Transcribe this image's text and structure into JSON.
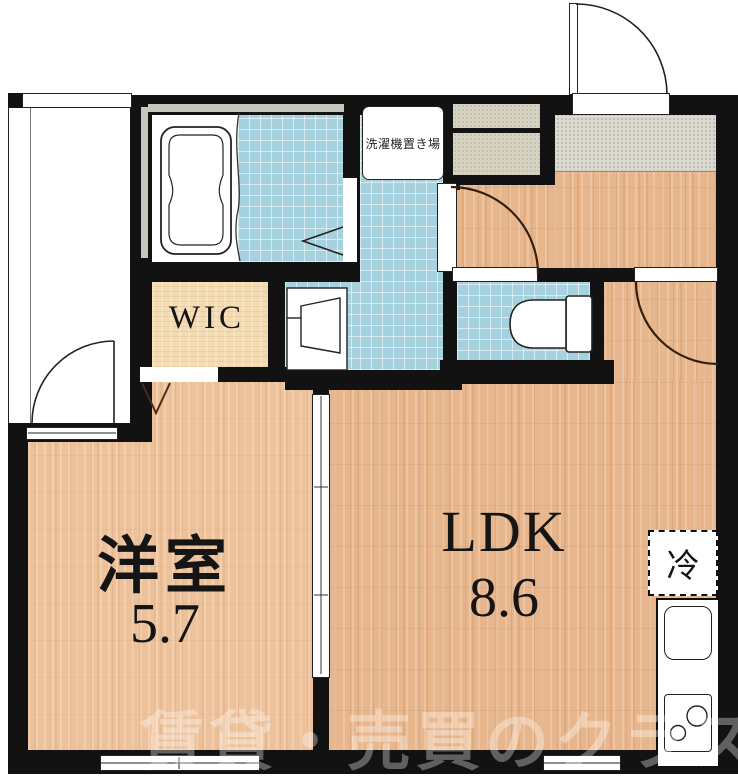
{
  "plan": {
    "title": "1LDK apartment floor plan",
    "rooms": {
      "western_room": {
        "label": "洋室",
        "size": "5.7"
      },
      "ldk": {
        "label": "LDK",
        "size": "8.6"
      },
      "wic": {
        "label": "WIC"
      },
      "laundry": {
        "label": "洗濯機置き場"
      },
      "refrigerator": {
        "label": "冷"
      }
    },
    "watermark": "賃貸・売買のクラスモ",
    "colors": {
      "wall": "#121212",
      "wood": "#e7b68c",
      "wood_light": "#edc29b",
      "tile": "#a6d1de",
      "wic": "#f3dbb3",
      "genkan": "#dcd9d0",
      "cabinet": "#d6d3c3",
      "window_gray": "#c6c6be",
      "door_arc": "#33200f"
    }
  }
}
